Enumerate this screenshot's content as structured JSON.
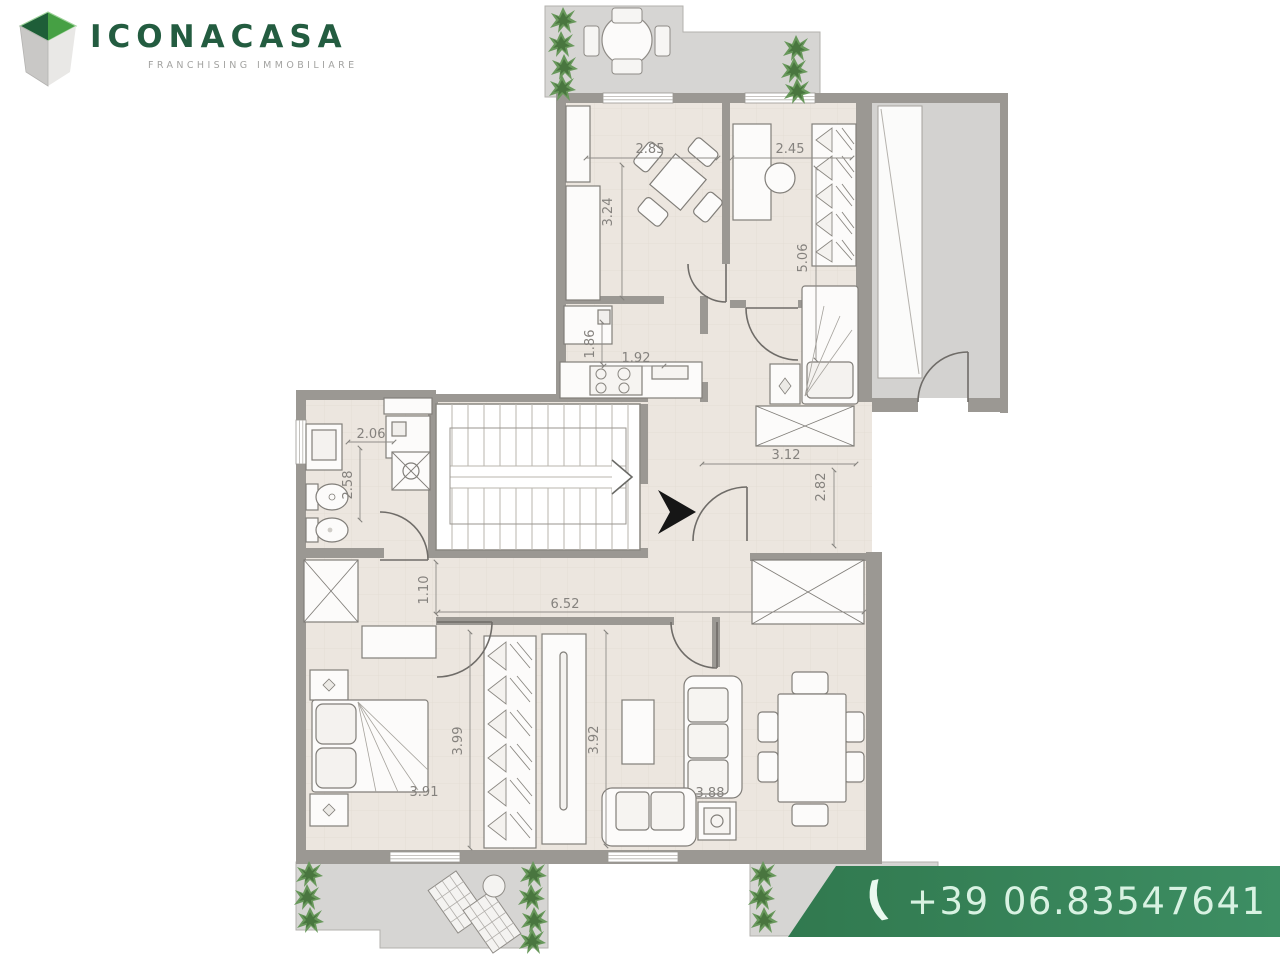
{
  "brand": {
    "name": "ICONACASA",
    "tagline": "FRANCHISING IMMOBILIARE",
    "logo_icon": "cube-logo-icon",
    "colors": {
      "logo_green": "#235c40",
      "cube_dark_green": "#1e5e38",
      "cube_light_green": "#46a044",
      "tagline_gray": "#a3a3a1"
    }
  },
  "contact": {
    "phone_icon": "phone-receiver-icon",
    "phone": "+39 06.83547641",
    "banner_green": "#3d8e63"
  },
  "plan": {
    "type": "apartment-floor-plan",
    "wall_color": "#9b9893",
    "floor_color": "#ece6df",
    "terrace_color": "#d6d5d3",
    "plant_color": "#68985b",
    "dims": {
      "study_width": "2.85",
      "study_height": "3.24",
      "room2_width": "2.45",
      "room2_height": "5.06",
      "kitchen_height": "1.86",
      "kitchen_width": "1.92",
      "bath_width": "2.06",
      "bath_height": "2.58",
      "hall_width": "3.12",
      "hall_height": "2.82",
      "hall_door": "1.10",
      "corridor_width": "6.52",
      "bedroom_height": "3.99",
      "living_height": "3.92",
      "bedroom_width": "3.91",
      "living_width": "3.88"
    }
  }
}
